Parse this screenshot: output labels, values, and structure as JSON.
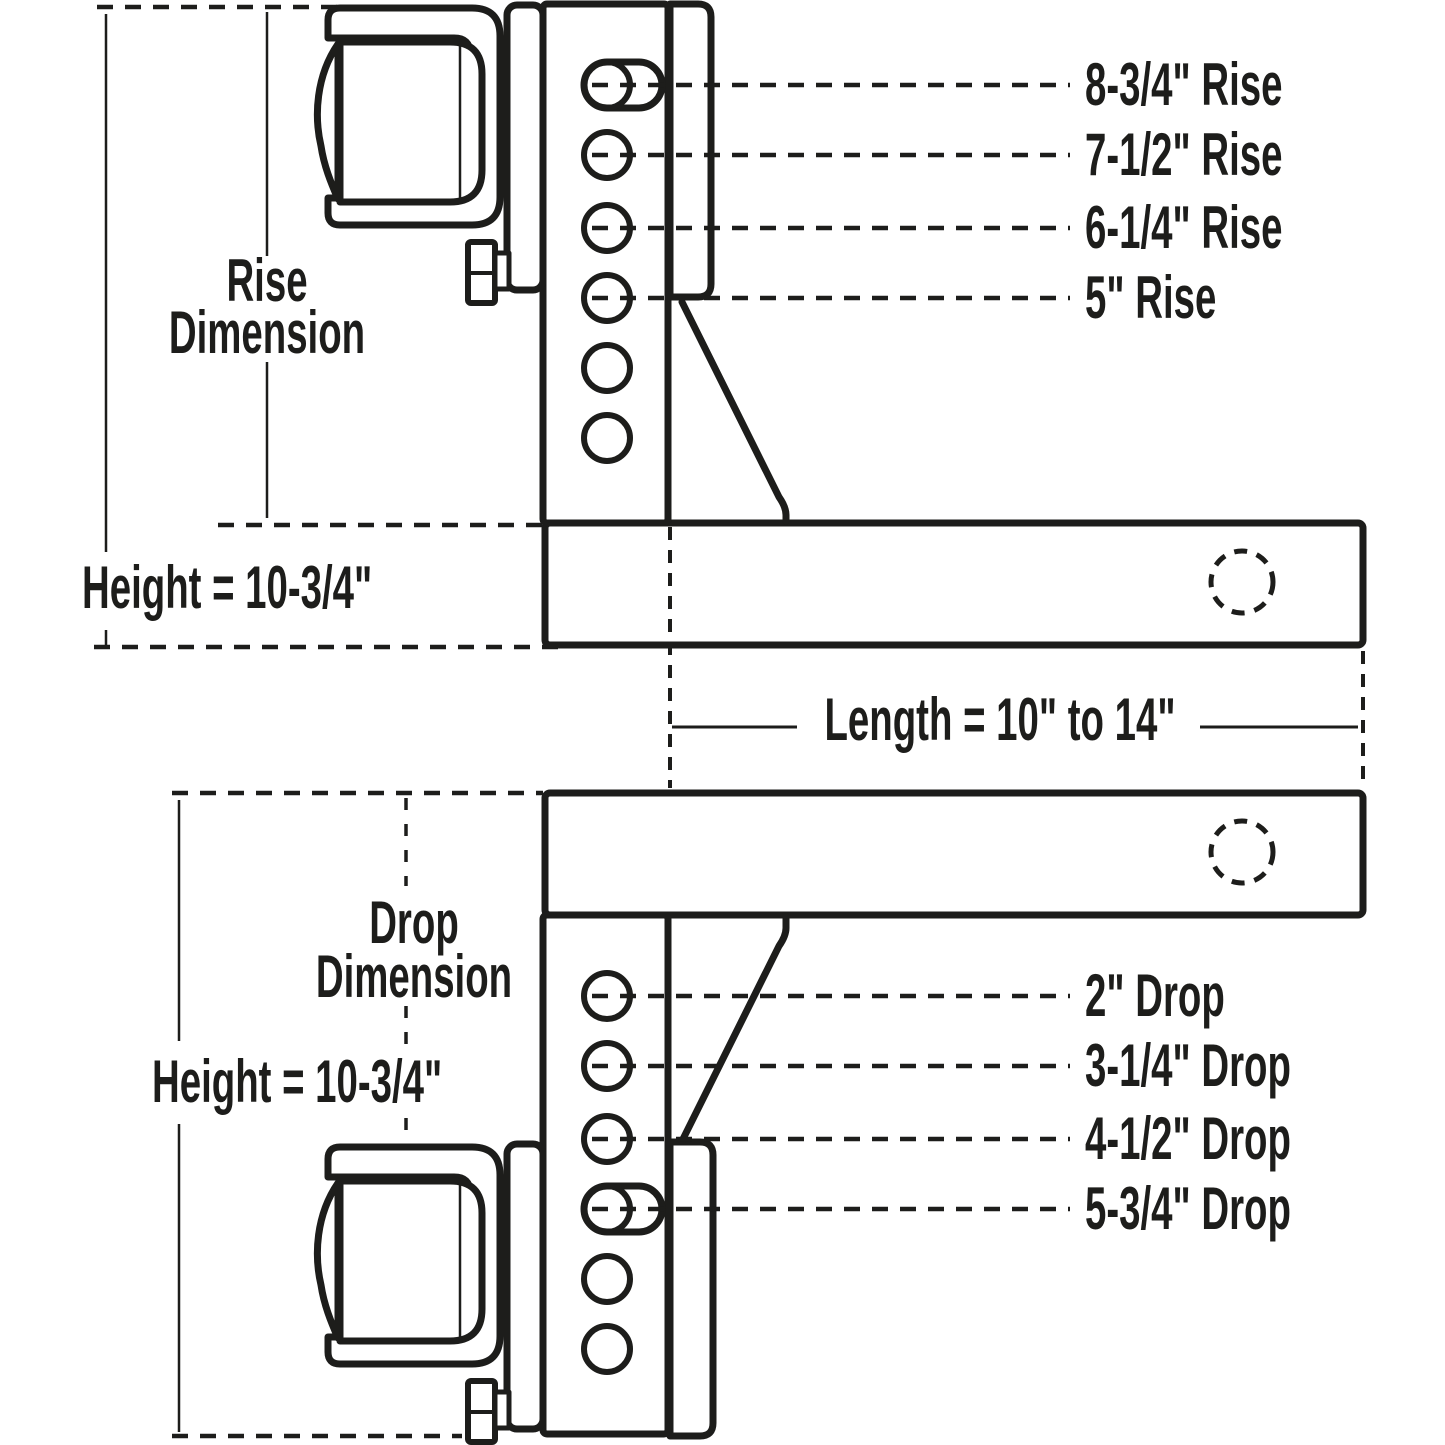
{
  "ink_color": "#1d1d1b",
  "background_color": "#ffffff",
  "top": {
    "rise_dimension": {
      "line1": "Rise",
      "line2": "Dimension"
    },
    "height": "Height = 10-3/4\"",
    "rise_labels": [
      "8-3/4\" Rise",
      "7-1/2\" Rise",
      "6-1/4\" Rise",
      "5\" Rise"
    ]
  },
  "middle": {
    "length": "Length = 10\" to 14\""
  },
  "bottom": {
    "drop_dimension": {
      "line1": "Drop",
      "line2": "Dimension"
    },
    "height": "Height = 10-3/4\"",
    "drop_labels": [
      "2\" Drop",
      "3-1/4\" Drop",
      "4-1/2\" Drop",
      "5-3/4\" Drop"
    ]
  }
}
